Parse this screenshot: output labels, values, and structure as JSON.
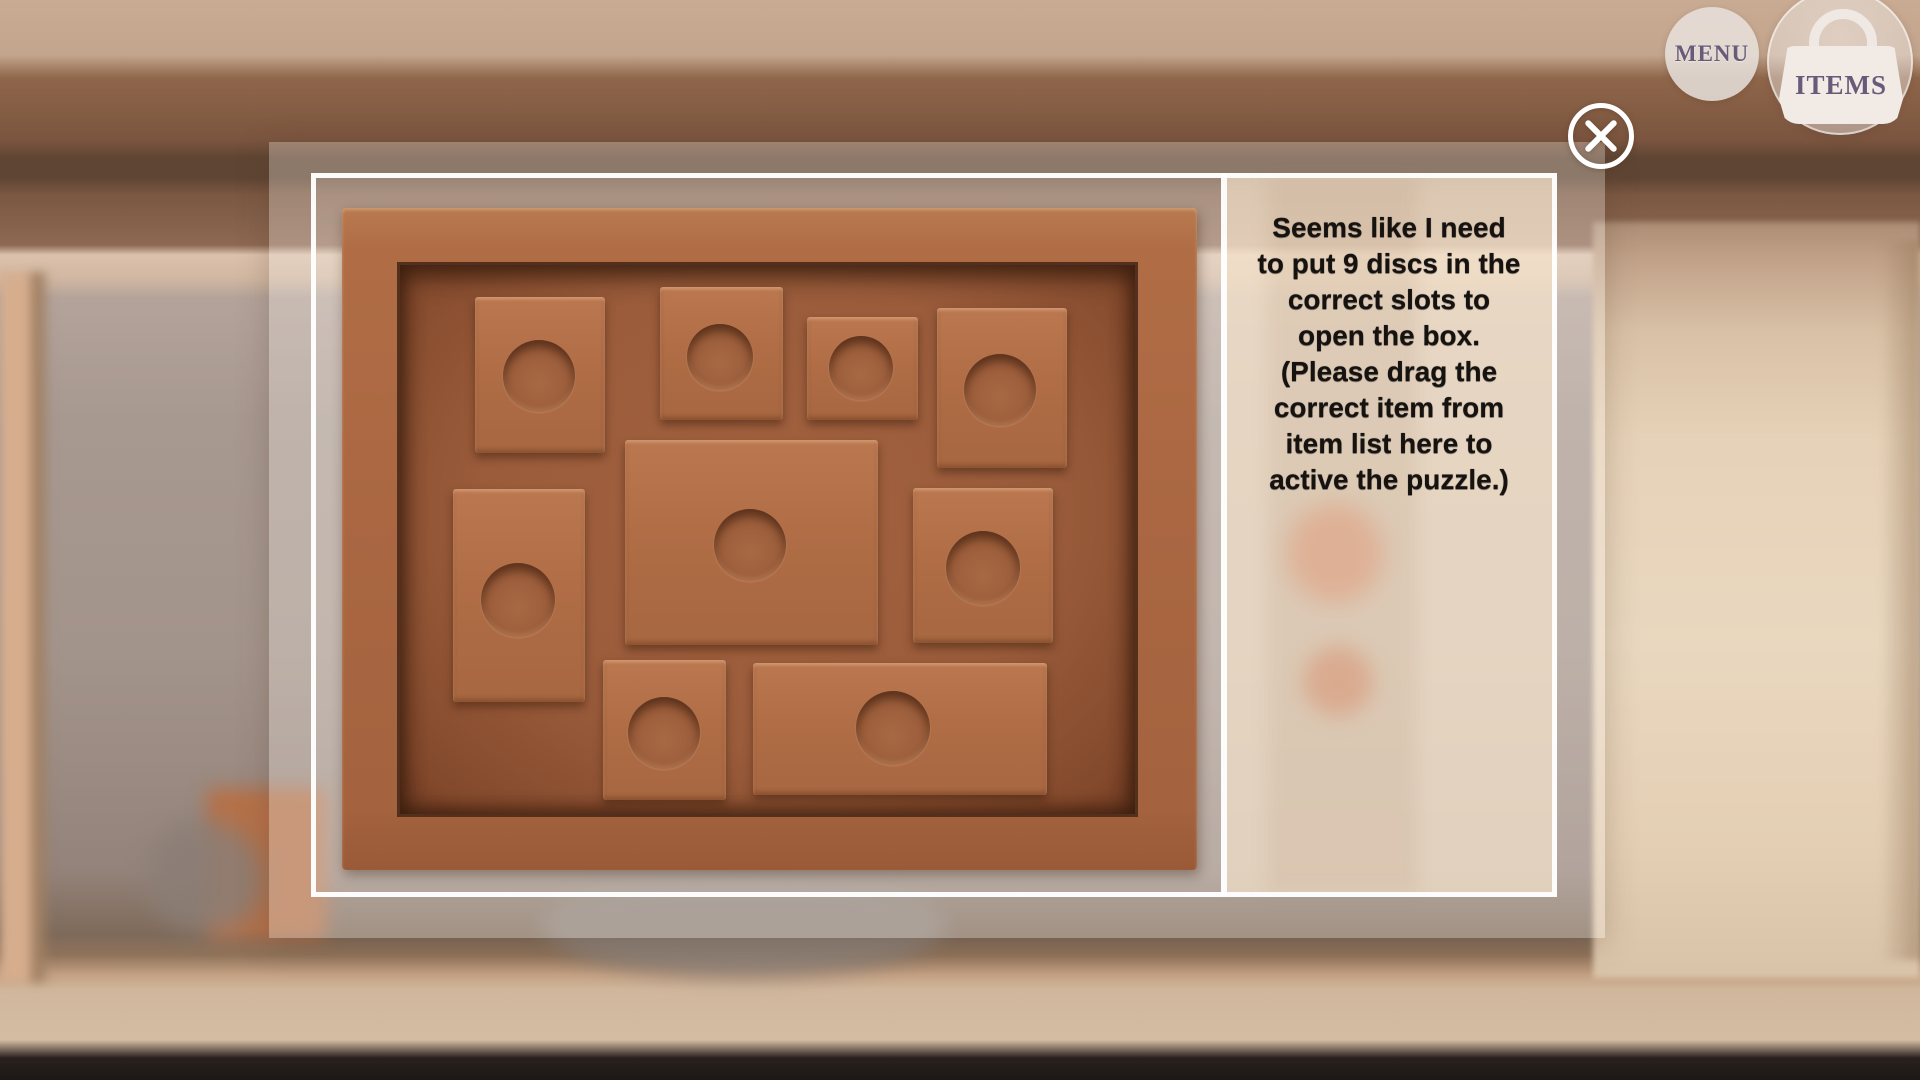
{
  "hud": {
    "menu_button": {
      "label": "MENU",
      "icon": "menu-circle-button"
    },
    "items_button": {
      "label": "ITEMS",
      "icon": "handbag"
    },
    "close_button": {
      "icon": "circle-x"
    }
  },
  "dialog": {
    "instruction": {
      "text": "Seems like I need\nto put 9 discs in the\ncorrect slots to\nopen the box.\n(Please drag the\ncorrect item from\nitem list here to\nactive the puzzle.)"
    },
    "puzzle_board": {
      "slot_count": 9,
      "slots": [
        {
          "id": "slot-top-1",
          "x": 475,
          "y": 297,
          "w": 130,
          "h": 156,
          "cx": 539,
          "cy": 376,
          "r": 36
        },
        {
          "id": "slot-top-2",
          "x": 660,
          "y": 287,
          "w": 123,
          "h": 133,
          "cx": 720,
          "cy": 357,
          "r": 33
        },
        {
          "id": "slot-top-3",
          "x": 807,
          "y": 317,
          "w": 111,
          "h": 103,
          "cx": 861,
          "cy": 368,
          "r": 32
        },
        {
          "id": "slot-top-4",
          "x": 937,
          "y": 308,
          "w": 130,
          "h": 160,
          "cx": 1000,
          "cy": 390,
          "r": 36
        },
        {
          "id": "slot-mid-left",
          "x": 453,
          "y": 489,
          "w": 132,
          "h": 213,
          "cx": 518,
          "cy": 600,
          "r": 37
        },
        {
          "id": "slot-center",
          "x": 625,
          "y": 440,
          "w": 253,
          "h": 205,
          "cx": 750,
          "cy": 545,
          "r": 36
        },
        {
          "id": "slot-mid-right",
          "x": 913,
          "y": 488,
          "w": 140,
          "h": 155,
          "cx": 983,
          "cy": 568,
          "r": 37
        },
        {
          "id": "slot-bottom-1",
          "x": 603,
          "y": 660,
          "w": 123,
          "h": 140,
          "cx": 664,
          "cy": 733,
          "r": 36
        },
        {
          "id": "slot-bottom-2",
          "x": 753,
          "y": 663,
          "w": 294,
          "h": 132,
          "cx": 893,
          "cy": 728,
          "r": 37
        }
      ]
    }
  },
  "colors": {
    "wood_frame": "#ae6a43",
    "wood_field": "#9c5d3a",
    "wood_slot": "#b06d46",
    "panel_beige": "#eedbc7",
    "border_white": "#ffffff",
    "accent_purple": "#6a5a7a"
  }
}
